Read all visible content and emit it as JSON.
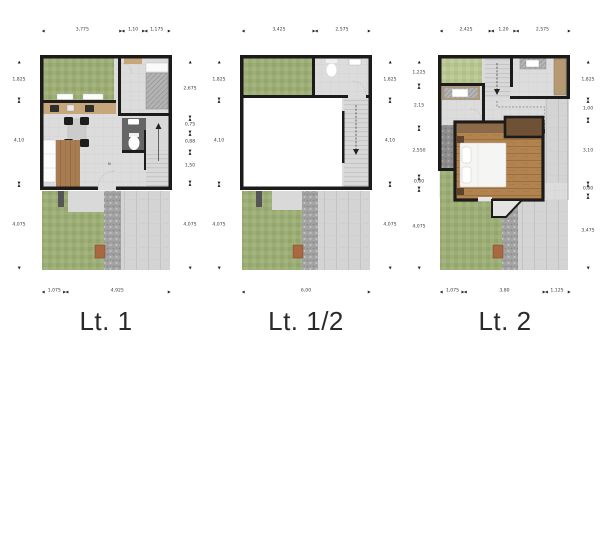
{
  "palette": {
    "wall": "#1d1b19",
    "floor_tile": "#dcdcdc",
    "grass": "#9cad75",
    "grass_light": "#b9c693",
    "driveway": "#d4d4d4",
    "pebble_path": "#a3a3a3",
    "balcony": "#8d8d8d",
    "wood_floor": "#b1834f",
    "wood_deck": "#a87c50",
    "counter": "#c8a67b",
    "wardrobe_dark": "#6f5135",
    "doormat": "#a9683f",
    "bath_floor": "#666666",
    "dim_text": "#3a3a3a",
    "label_text": "#2a2a2a"
  },
  "plans": [
    {
      "label": "Lt. 1",
      "north_mark": "N",
      "dims": {
        "top": [
          "3,775",
          "1,10",
          "1,175"
        ],
        "bottom": [
          "1,075",
          "4,925"
        ],
        "left": [
          "1,825",
          "4,10",
          "4,075"
        ],
        "right": [
          "2,675",
          "0,75",
          "0,88",
          "1,50",
          "4,075"
        ]
      }
    },
    {
      "label": "Lt. 1/2",
      "dims": {
        "top": [
          "3,425",
          "2,575"
        ],
        "bottom": [
          "6,00"
        ],
        "left": [
          "1,825",
          "4,10",
          "4,075"
        ],
        "right": [
          "1,825",
          "4,10",
          "4,075"
        ]
      }
    },
    {
      "label": "Lt. 2",
      "dims": {
        "top": [
          "2,425",
          "1,20",
          "2,575"
        ],
        "bottom": [
          "1,075",
          "3,80",
          "1,125"
        ],
        "left": [
          "1,225",
          "2,15",
          "2,550",
          "0,60",
          "4,075"
        ],
        "right": [
          "1,825",
          "1,00",
          "3,10",
          "0,60",
          "3,475"
        ]
      }
    }
  ]
}
